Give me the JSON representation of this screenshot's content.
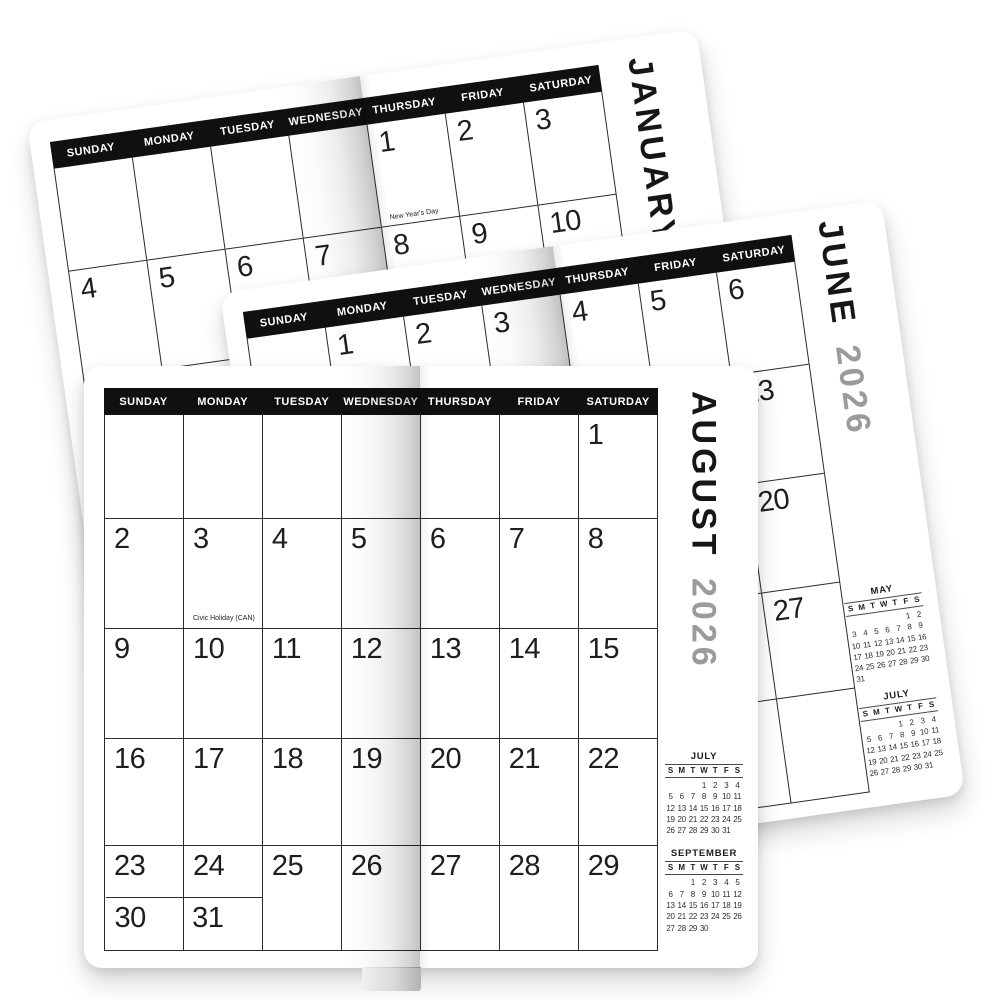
{
  "colors": {
    "header_bar": "#101010",
    "grid_line": "#2b2b2b",
    "date_number": "#1e1e1e",
    "year_text": "#9b9b9b",
    "page_background": "#ffffff"
  },
  "pages": [
    {
      "id": "january",
      "title_month": "JANUARY",
      "day_headers": [
        "SUNDAY",
        "MONDAY",
        "TUESDAY",
        "WEDNESDAY",
        "THURSDAY",
        "FRIDAY",
        "SATURDAY"
      ],
      "weeks": [
        [
          "",
          "",
          "",
          "",
          "1",
          "2",
          "3"
        ],
        [
          "4",
          "5",
          "6",
          "7",
          "8",
          "9",
          "10"
        ],
        [
          "11",
          "12",
          "13",
          "14",
          "15",
          "16",
          "17"
        ],
        [
          "18",
          "19",
          "20",
          "21",
          "22",
          "23",
          "24"
        ],
        [
          "25",
          "26",
          "27",
          "28",
          "29",
          "30",
          "31"
        ]
      ],
      "notes": [
        {
          "date": "1",
          "text": "New Year's Day"
        }
      ],
      "mini_calendars": []
    },
    {
      "id": "june",
      "title_month": "JUNE",
      "title_year": "2026",
      "day_headers": [
        "SUNDAY",
        "MONDAY",
        "TUESDAY",
        "WEDNESDAY",
        "THURSDAY",
        "FRIDAY",
        "SATURDAY"
      ],
      "weeks": [
        [
          "",
          "1",
          "2",
          "3",
          "4",
          "5",
          "6"
        ],
        [
          "7",
          "8",
          "9",
          "10",
          "11",
          "12",
          "13"
        ],
        [
          "14",
          "15",
          "16",
          "17",
          "18",
          "19",
          "20"
        ],
        [
          "21",
          "22",
          "23",
          "24",
          "25",
          "26",
          "27"
        ],
        [
          "28",
          "29",
          "30",
          "",
          "",
          "",
          ""
        ]
      ],
      "notes": [],
      "mini_calendars": [
        {
          "title": "MAY",
          "day_letters": [
            "S",
            "M",
            "T",
            "W",
            "T",
            "F",
            "S"
          ],
          "weeks": [
            [
              "",
              "",
              "",
              "",
              "",
              "1",
              "2"
            ],
            [
              "3",
              "4",
              "5",
              "6",
              "7",
              "8",
              "9"
            ],
            [
              "10",
              "11",
              "12",
              "13",
              "14",
              "15",
              "16"
            ],
            [
              "17",
              "18",
              "19",
              "20",
              "21",
              "22",
              "23"
            ],
            [
              "24",
              "25",
              "26",
              "27",
              "28",
              "29",
              "30"
            ],
            [
              "31",
              "",
              "",
              "",
              "",
              "",
              ""
            ]
          ]
        },
        {
          "title": "JULY",
          "day_letters": [
            "S",
            "M",
            "T",
            "W",
            "T",
            "F",
            "S"
          ],
          "weeks": [
            [
              "",
              "",
              "",
              "1",
              "2",
              "3",
              "4"
            ],
            [
              "5",
              "6",
              "7",
              "8",
              "9",
              "10",
              "11"
            ],
            [
              "12",
              "13",
              "14",
              "15",
              "16",
              "17",
              "18"
            ],
            [
              "19",
              "20",
              "21",
              "22",
              "23",
              "24",
              "25"
            ],
            [
              "26",
              "27",
              "28",
              "29",
              "30",
              "31",
              ""
            ]
          ]
        }
      ]
    },
    {
      "id": "august",
      "title_month": "AUGUST",
      "title_year": "2026",
      "day_headers": [
        "SUNDAY",
        "MONDAY",
        "TUESDAY",
        "WEDNESDAY",
        "THURSDAY",
        "FRIDAY",
        "SATURDAY"
      ],
      "weeks": [
        [
          "",
          "",
          "",
          "",
          "",
          "",
          "1"
        ],
        [
          "2",
          "3",
          "4",
          "5",
          "6",
          "7",
          "8"
        ],
        [
          "9",
          "10",
          "11",
          "12",
          "13",
          "14",
          "15"
        ],
        [
          "16",
          "17",
          "18",
          "19",
          "20",
          "21",
          "22"
        ],
        [
          "23",
          "24",
          "25",
          "26",
          "27",
          "28",
          "29"
        ]
      ],
      "extra_week": [
        "30",
        "31"
      ],
      "notes": [
        {
          "date": "3",
          "text": "Civic Holiday (CAN)"
        }
      ],
      "mini_calendars": [
        {
          "title": "JULY",
          "day_letters": [
            "S",
            "M",
            "T",
            "W",
            "T",
            "F",
            "S"
          ],
          "weeks": [
            [
              "",
              "",
              "",
              "1",
              "2",
              "3",
              "4"
            ],
            [
              "5",
              "6",
              "7",
              "8",
              "9",
              "10",
              "11"
            ],
            [
              "12",
              "13",
              "14",
              "15",
              "16",
              "17",
              "18"
            ],
            [
              "19",
              "20",
              "21",
              "22",
              "23",
              "24",
              "25"
            ],
            [
              "26",
              "27",
              "28",
              "29",
              "30",
              "31",
              ""
            ]
          ]
        },
        {
          "title": "SEPTEMBER",
          "day_letters": [
            "S",
            "M",
            "T",
            "W",
            "T",
            "F",
            "S"
          ],
          "weeks": [
            [
              "",
              "",
              "1",
              "2",
              "3",
              "4",
              "5"
            ],
            [
              "6",
              "7",
              "8",
              "9",
              "10",
              "11",
              "12"
            ],
            [
              "13",
              "14",
              "15",
              "16",
              "17",
              "18",
              "19"
            ],
            [
              "20",
              "21",
              "22",
              "23",
              "24",
              "25",
              "26"
            ],
            [
              "27",
              "28",
              "29",
              "30",
              "",
              "",
              ""
            ]
          ]
        }
      ]
    }
  ]
}
